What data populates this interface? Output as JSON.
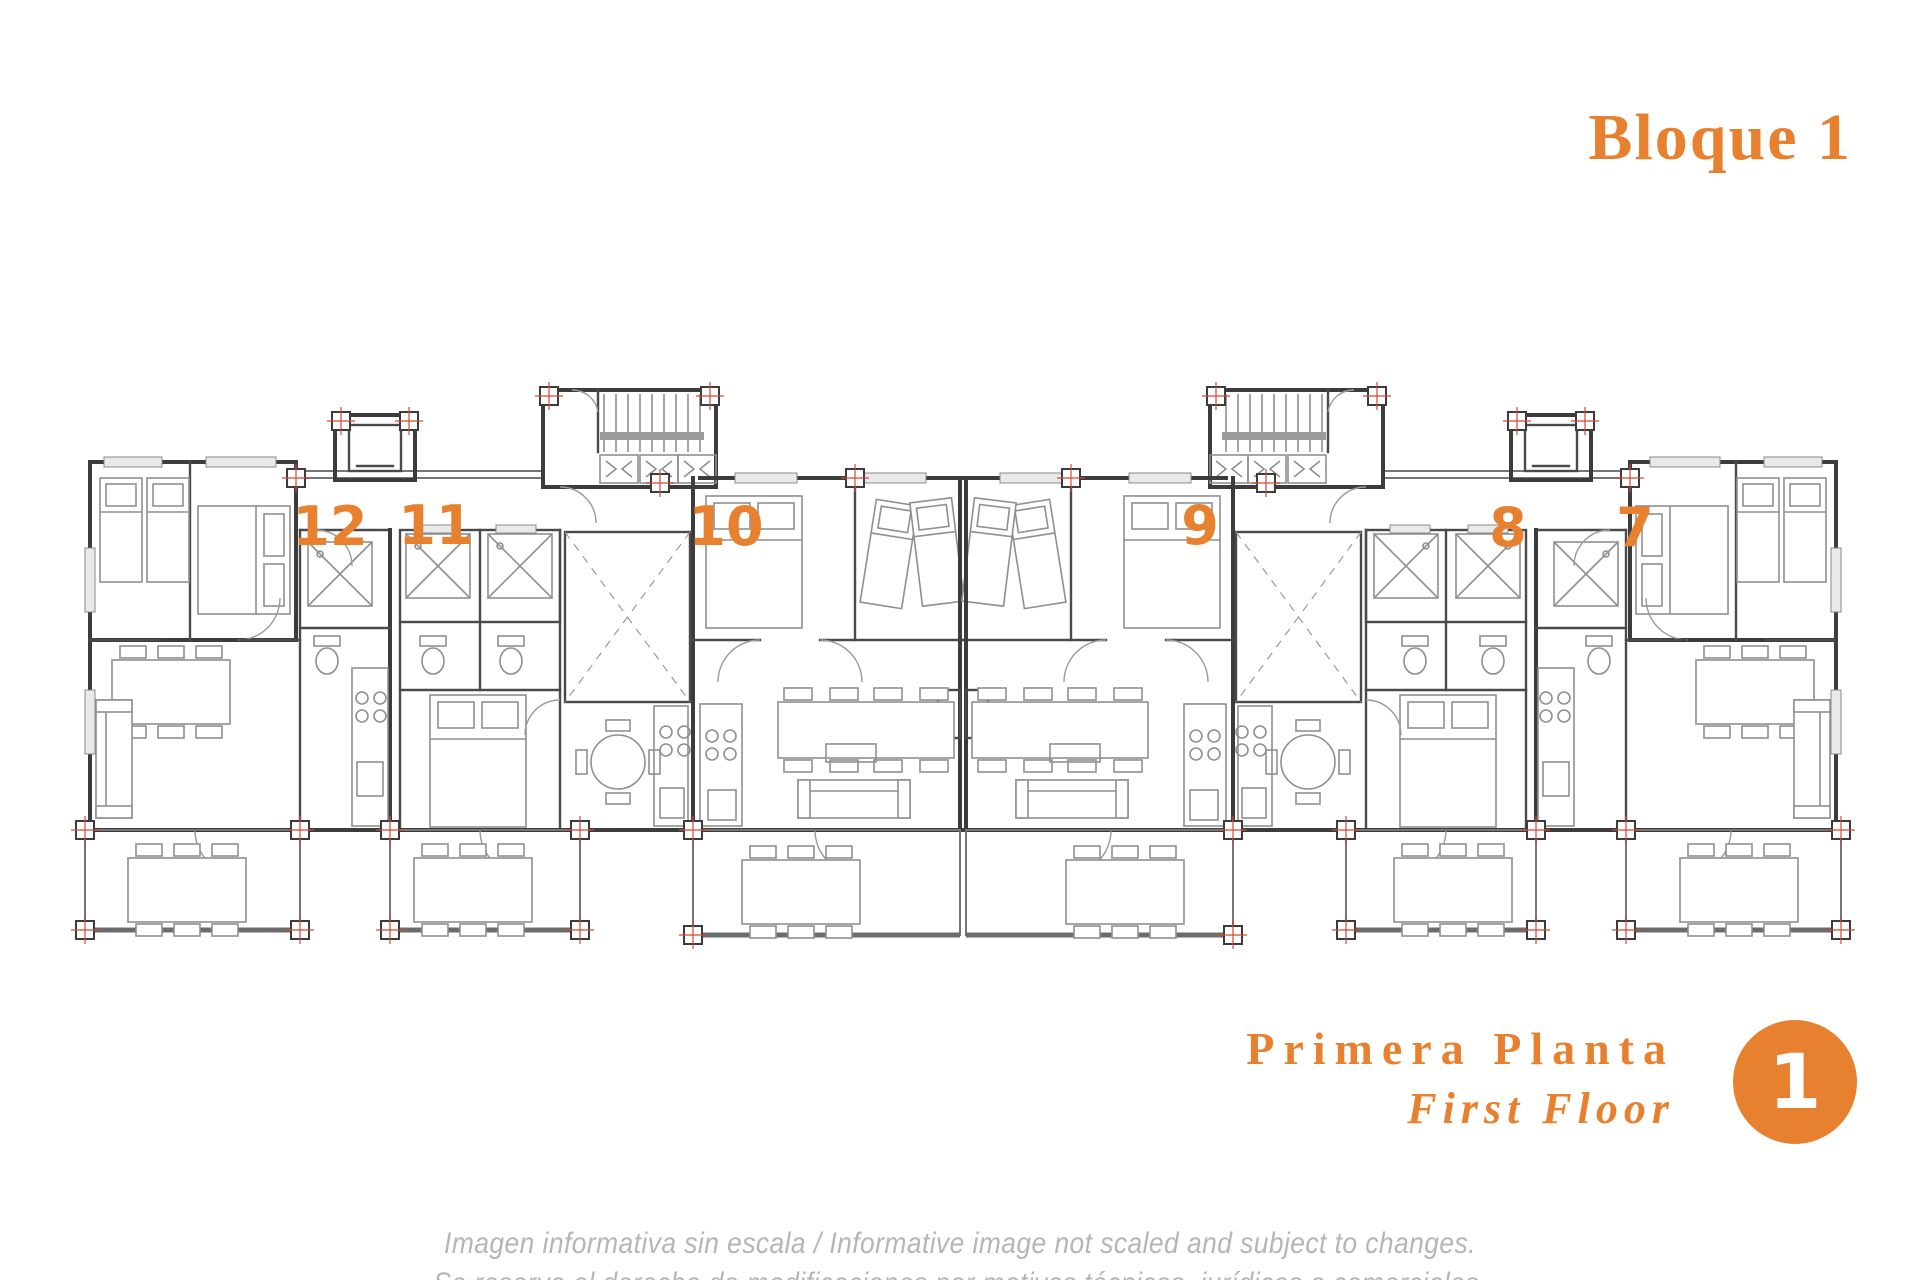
{
  "header": {
    "title": "Bloque 1"
  },
  "apartments": [
    {
      "number": "12"
    },
    {
      "number": "11"
    },
    {
      "number": "10"
    },
    {
      "number": "9"
    },
    {
      "number": "8"
    },
    {
      "number": "7"
    }
  ],
  "floor_label": {
    "primary": "Primera Planta",
    "secondary": "First Floor",
    "badge": "1"
  },
  "disclaimer": {
    "line1": "Imagen informativa sin escala /  Informative image not scaled and subject to changes.",
    "line2": "Se reserva el derecho de modificaciones por motivos técnicos, jurídicos o comerciales."
  },
  "colors": {
    "accent": "#E8812F",
    "wall": "#3c3c3c",
    "furniture": "#8f8f8f",
    "muted": "#b5b5b5"
  }
}
